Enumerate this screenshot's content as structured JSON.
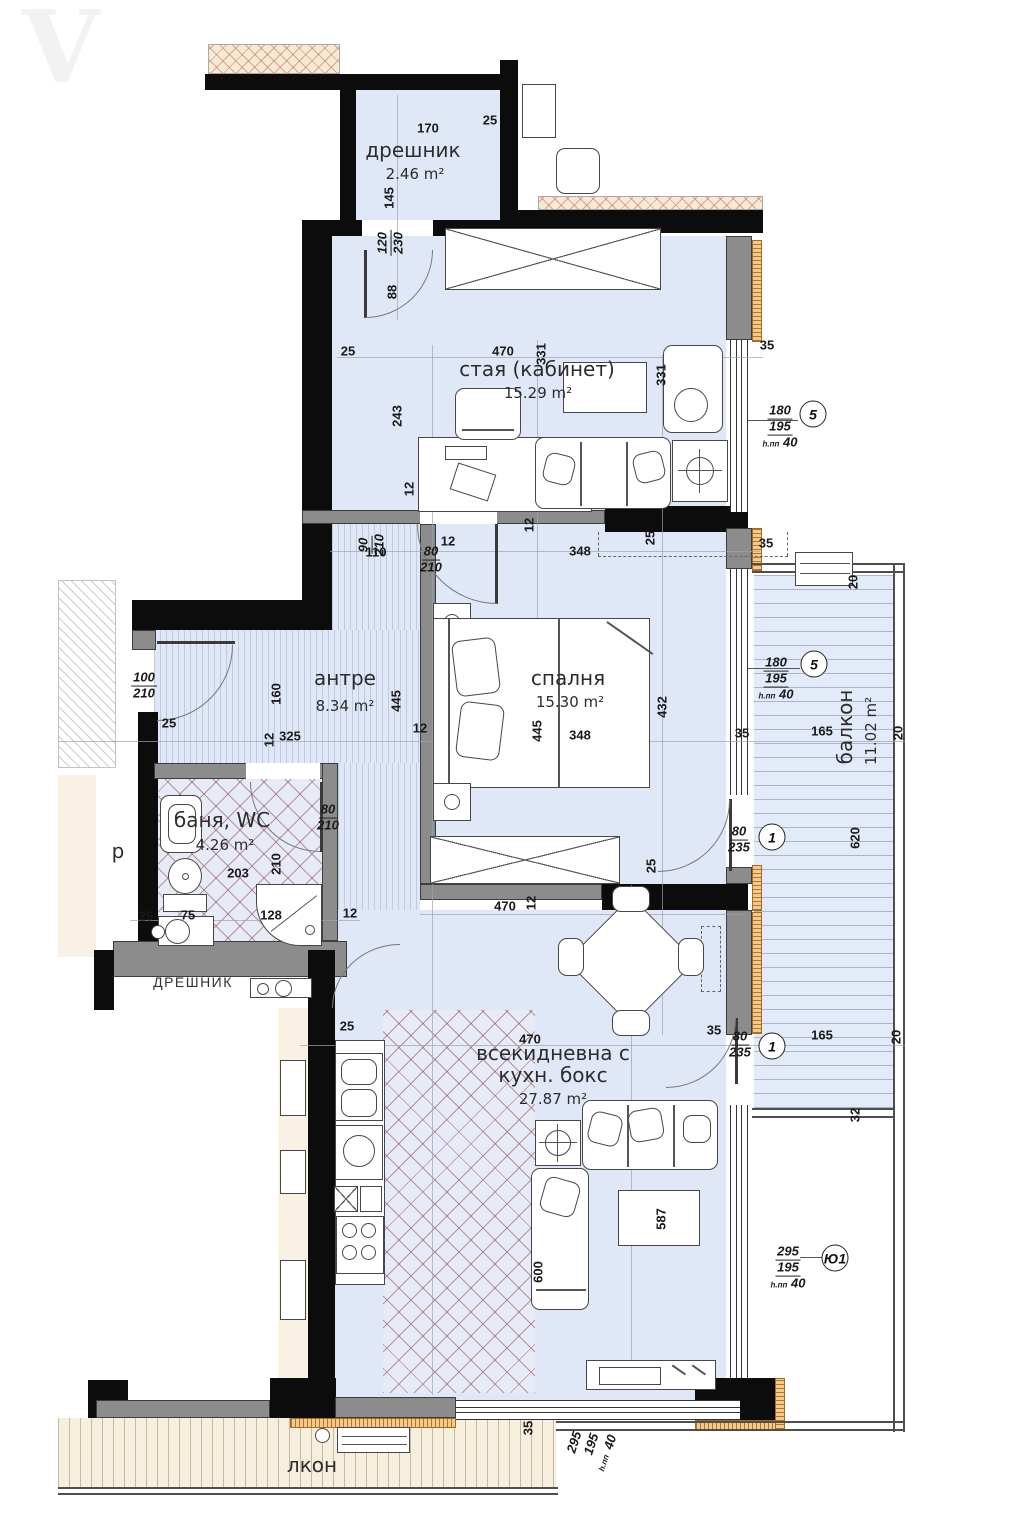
{
  "watermark": "V",
  "rooms": {
    "closet": {
      "name": "дрешник",
      "area": "2.46 m²"
    },
    "study": {
      "name": "стая (кабинет)",
      "area": "15.29 m²"
    },
    "hall": {
      "name": "антре",
      "area": "8.34 m²"
    },
    "bedroom": {
      "name": "спалня",
      "area": "15.30 m²"
    },
    "bath": {
      "name": "баня, WC",
      "area": "4.26 m²"
    },
    "living": {
      "name_line1": "всекидневна с",
      "name_line2": "кухн. бокс",
      "area": "27.87 m²"
    },
    "balcony": {
      "name": "балкон",
      "area": "11.02 m²"
    },
    "balcony_south": {
      "name": "лкон"
    },
    "neighbor_closet": {
      "name": "ДРЕШНИК"
    },
    "corridor_fragment": "р"
  },
  "labels": {
    "d170": "170",
    "d25": "25",
    "d145": "145",
    "d120": "120",
    "d230": "230",
    "d88": "88",
    "d470": "470",
    "d331": "331",
    "d243": "243",
    "d12": "12",
    "d35": "35",
    "d90": "90",
    "d210": "210",
    "d110": "110",
    "d80": "80",
    "d348": "348",
    "d445": "445",
    "d432": "432",
    "d100": "100",
    "d160": "160",
    "d325": "325",
    "d203": "203",
    "d75": "75",
    "d128": "128",
    "d180": "180",
    "d195": "195",
    "d40": "40",
    "d165": "165",
    "d20": "20",
    "d235": "235",
    "d620": "620",
    "d600": "600",
    "d587": "587",
    "d295": "295",
    "d32": "32",
    "hpp": "h.пп",
    "m5": "5",
    "m1": "1",
    "myu1": "Ю1"
  },
  "colors": {
    "floor_blue": "#e0e7f6",
    "wall_black": "#0c0c0c",
    "wall_gray": "#8c8c8c",
    "tile_hatch": "#8d4650",
    "insulation": "#f4c98c",
    "neighbor_hatch": "#f8e9d4",
    "balcony_cream": "#f6efde"
  }
}
